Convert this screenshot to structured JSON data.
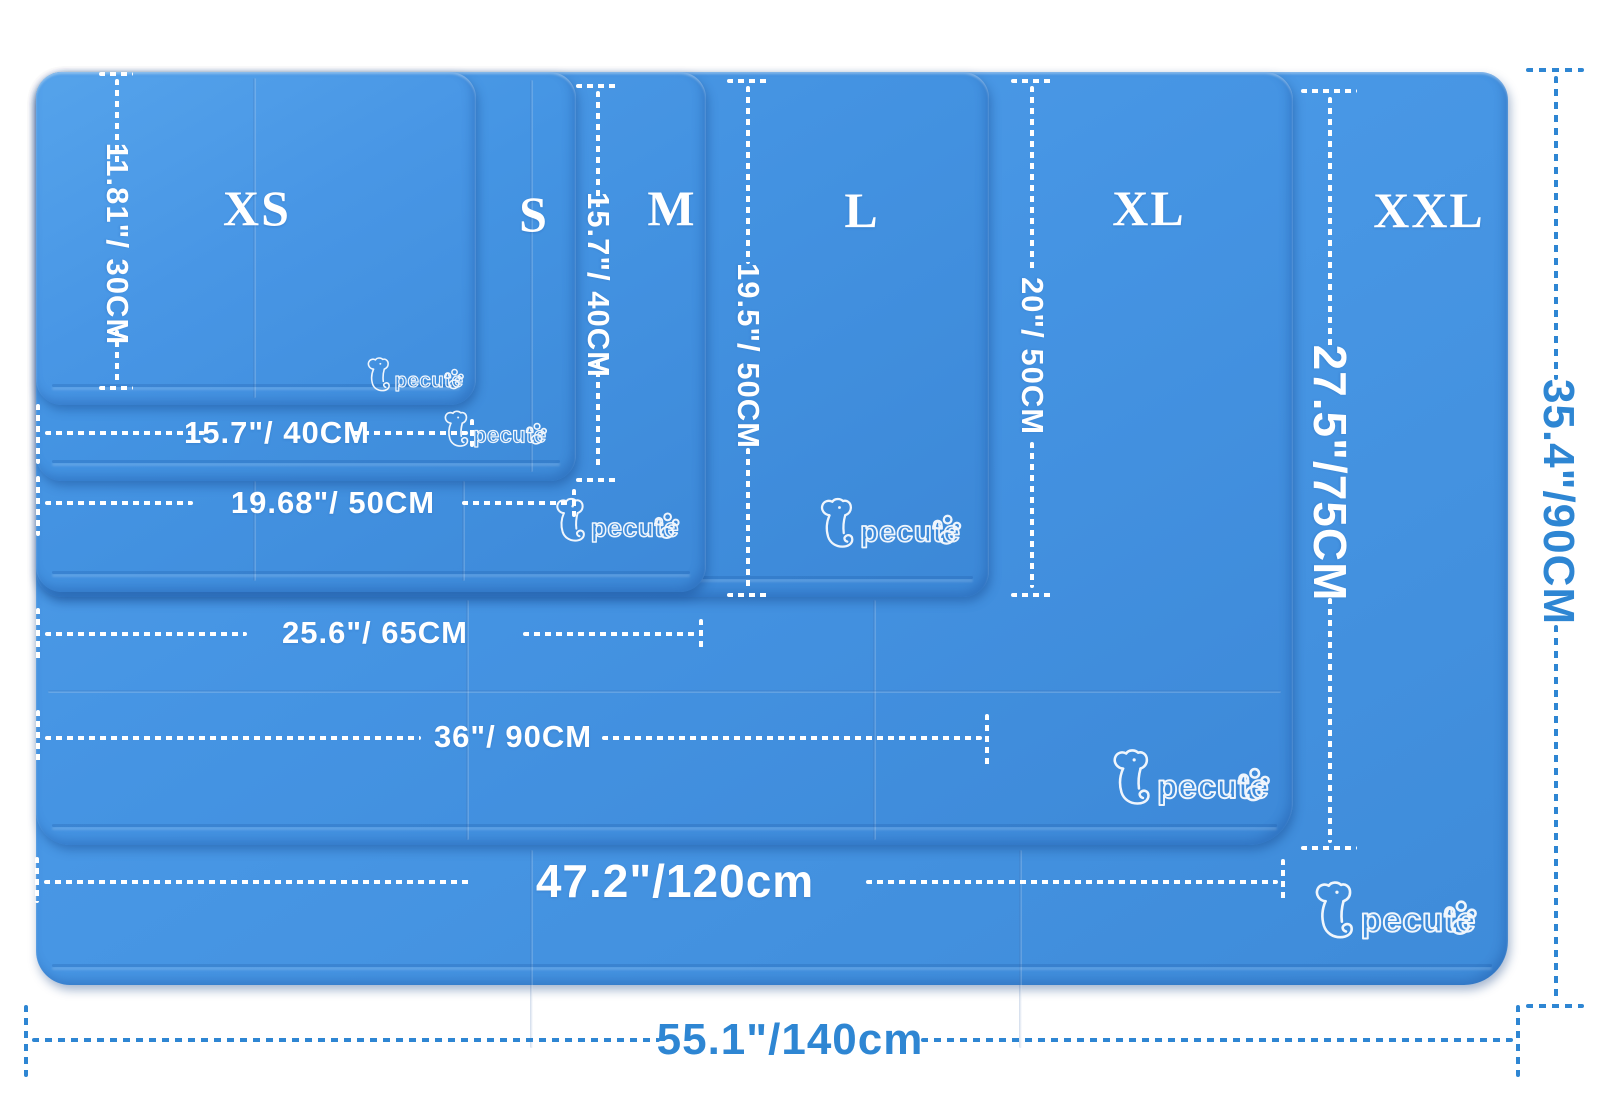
{
  "image": {
    "type": "product-size-chart",
    "background": "#FFFFFF"
  },
  "brand": {
    "logo_text": "pecute"
  },
  "sizes": [
    {
      "id": "xs",
      "label": "XS",
      "width_label": "15.7\"/ 40CM",
      "height_label": "11.81\"/ 30CM"
    },
    {
      "id": "s",
      "label": "S",
      "width_label": "19.68\"/ 50CM",
      "height_label": "15.7\"/ 40CM"
    },
    {
      "id": "m",
      "label": "M",
      "width_label": "25.6\"/ 65CM",
      "height_label": "19.5\"/ 50CM"
    },
    {
      "id": "l",
      "label": "L",
      "width_label": "36\"/ 90CM",
      "height_label": "20\"/ 50CM"
    },
    {
      "id": "xl",
      "label": "XL",
      "width_label": "47.2\"/120cm",
      "height_label": "27.5\"/75CM"
    },
    {
      "id": "xxl",
      "label": "XXL",
      "width_label": "55.1\"/140cm",
      "height_label": "35.4\"/90CM"
    }
  ],
  "colors": {
    "mat_blue": "#4493E2",
    "mat_blue_light": "#55A2EA",
    "mat_blue_dark": "#3A87D6",
    "dimension_line_on_mat": "#FFFFFF",
    "dimension_line_outside": "#2E86D3",
    "size_label_text": "#FFFFFF"
  }
}
